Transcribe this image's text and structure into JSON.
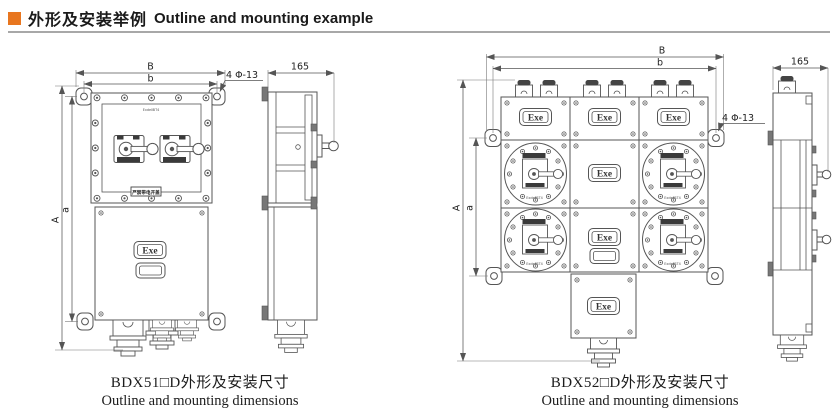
{
  "header": {
    "title_zh": "外形及安装举例",
    "title_en": "Outline and mounting example",
    "accent_color": "#e8761f"
  },
  "labels": {
    "exe": "Exe",
    "marking": "ExdeⅡBT4",
    "warning": "严禁带电开盖"
  },
  "figure_left": {
    "model": "BDX51",
    "caption_zh": "BDX51□D外形及安装尺寸",
    "caption_en": "Outline and mounting dimensions",
    "dim_B": "B",
    "dim_b": "b",
    "dim_A": "A",
    "dim_a": "a",
    "dim_depth": "165",
    "dim_holes": "4 Φ-13"
  },
  "figure_right": {
    "model": "BDX52",
    "caption_zh": "BDX52□D外形及安装尺寸",
    "caption_en": "Outline and mounting dimensions",
    "dim_B": "B",
    "dim_b": "b",
    "dim_A": "A",
    "dim_a": "a",
    "dim_depth": "165",
    "dim_holes": "4 Φ-13"
  }
}
